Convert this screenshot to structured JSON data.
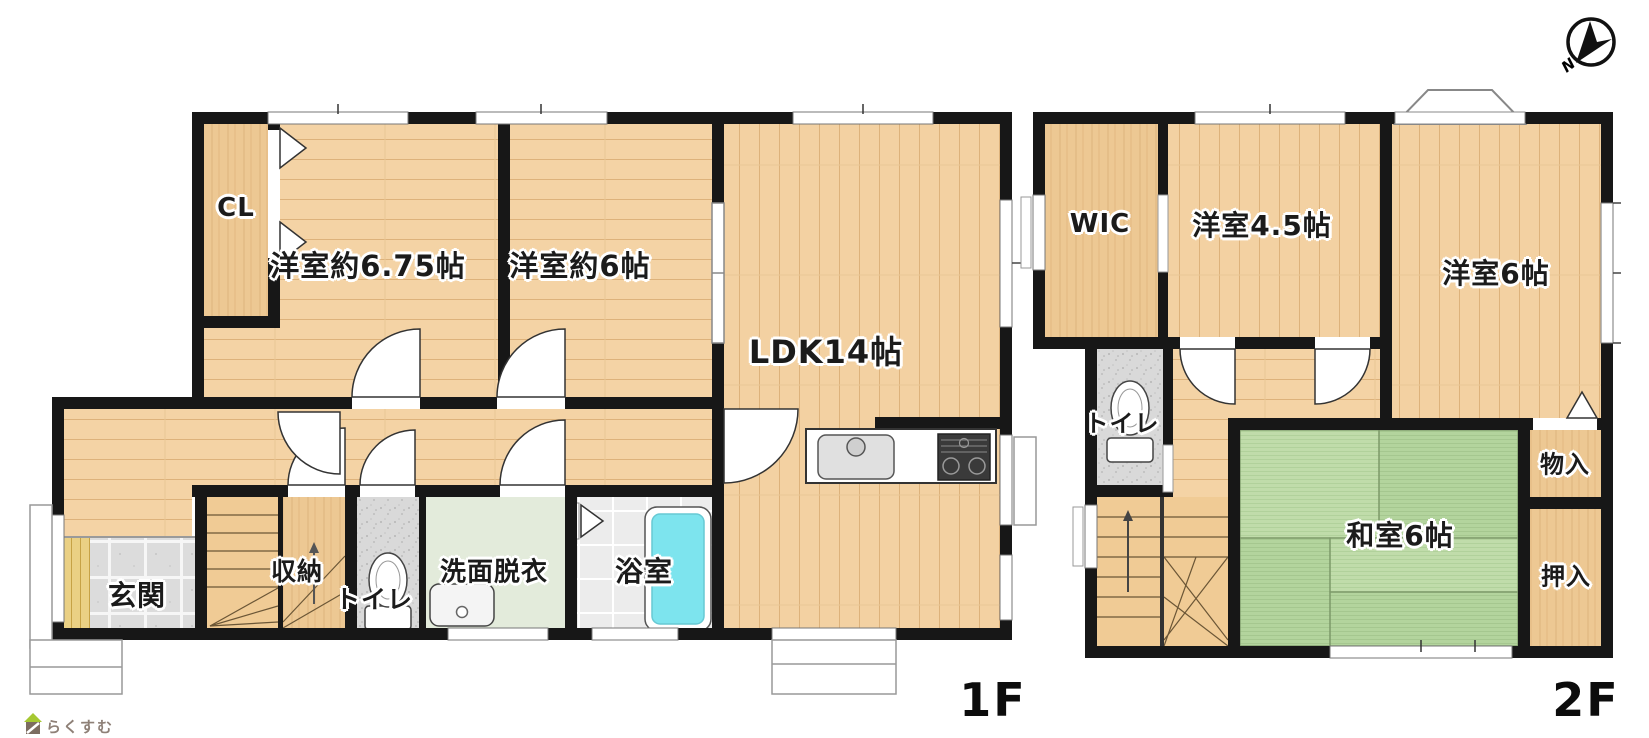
{
  "floor_plan": {
    "floors": [
      {
        "id": "1F",
        "label": "1F",
        "rooms": [
          {
            "id": "cl",
            "label": "CL"
          },
          {
            "id": "bedroom-675",
            "label": "洋室約6.75帖"
          },
          {
            "id": "bedroom-6",
            "label": "洋室約6帖"
          },
          {
            "id": "ldk",
            "label": "LDK14帖"
          },
          {
            "id": "genkan",
            "label": "玄関"
          },
          {
            "id": "shuno",
            "label": "収納"
          },
          {
            "id": "toilet-1f",
            "label": "トイレ"
          },
          {
            "id": "senmen",
            "label": "洗面脱衣"
          },
          {
            "id": "bathroom",
            "label": "浴室"
          }
        ]
      },
      {
        "id": "2F",
        "label": "2F",
        "rooms": [
          {
            "id": "wic",
            "label": "WIC"
          },
          {
            "id": "bedroom-45",
            "label": "洋室4.5帖"
          },
          {
            "id": "bedroom-6-2f",
            "label": "洋室6帖"
          },
          {
            "id": "toilet-2f",
            "label": "トイレ"
          },
          {
            "id": "washitsu",
            "label": "和室6帖"
          },
          {
            "id": "mono-ire",
            "label": "物入"
          },
          {
            "id": "oshi-ire",
            "label": "押入"
          }
        ]
      }
    ],
    "compass": {
      "label": "N"
    },
    "logo": {
      "text": "らくすむ"
    },
    "colors": {
      "wall": "#171717",
      "wood_floor": "#f4d3a5",
      "closet_wood": "#edc893",
      "tatami_green": "#b9d8a2",
      "bathtub_cyan": "#7de4ee",
      "entry_tile": "#dcdcdc",
      "washroom_floor": "#e3ebdb",
      "stair_floor": "#f0cb95"
    }
  }
}
